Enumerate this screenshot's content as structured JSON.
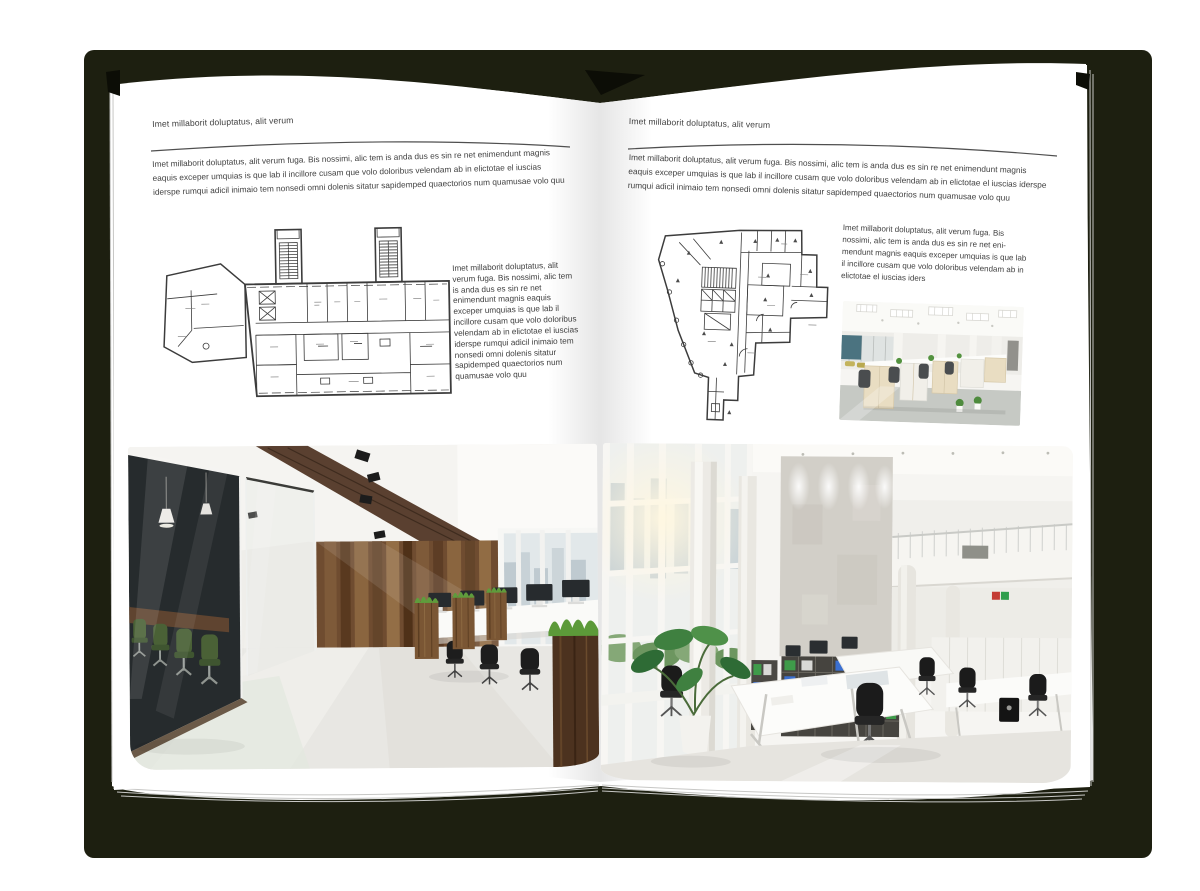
{
  "page_left": {
    "header": "Imet millaborit doluptatus, alit verum",
    "intro": "Imet millaborit doluptatus, alit verum fuga. Bis nossimi, alic tem is anda dus es sin re net enimendunt magnis eaquis exceper umquias is que lab il incillore cusam que volo doloribus velendam ab in elictotae el iuscias iderspe rumqui adicil inimaio tem nonsedi omni dolenis sitatur sapidemped quaectorios num quamusae volo quu",
    "sidebar": "Imet millaborit doluptatus, alit verum fuga. Bis nossimi, alic tem is anda dus es sin re net enimendunt magnis eaquis exceper umquias is que lab il incillore cusam que volo doloribus velendam ab in elictotae el iuscias iderspe rumqui adicil inimaio tem nonsedi omni dolenis sitatur sapidemped quaectorios num quamusae volo quu"
  },
  "page_right": {
    "header": "Imet millaborit doluptatus, alit verum",
    "intro": "Imet millaborit doluptatus, alit verum fuga. Bis nossimi, alic tem is anda dus es sin re net enimendunt magnis eaquis exceper umquias is que lab il incillore cusam que volo doloribus velendam ab in elictotae el iuscias iderspe rumqui adicil inimaio tem nonsedi omni dolenis sitatur sapidemped quaectorios num quamusae volo quu",
    "sidebar": "Imet millaborit doluptatus, alit verum fuga. Bis nossimi, alic tem is anda dus es sin re net eni-mendunt magnis eaquis exceper umquias is que lab il incillore cusam que volo doloribus velendam ab in elictotae el iuscias iders"
  },
  "colors": {
    "cover": "#1d1f10",
    "page": "#ffffff",
    "text": "#3f3f3f",
    "rule": "#4f4f4f"
  }
}
